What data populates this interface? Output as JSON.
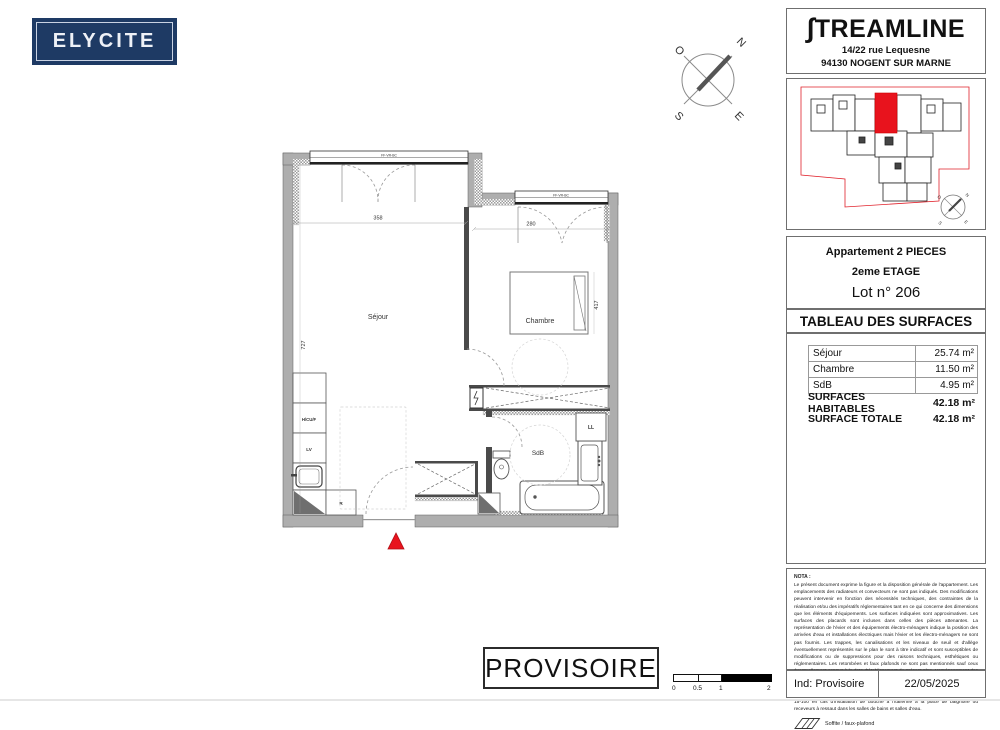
{
  "logo_elycite": {
    "text": "ELYCITE"
  },
  "header_right": {
    "brand_initial": "∫",
    "brand_rest": "TREAMLINE",
    "address1": "14/22 rue Lequesne",
    "address2": "94130 NOGENT SUR MARNE"
  },
  "compass": {
    "n": "N",
    "o": "O",
    "s": "S",
    "e": "E"
  },
  "apartment": {
    "type": "Appartement 2 PIECES",
    "floor": "2eme ETAGE",
    "lot": "Lot n° 206"
  },
  "surfaces": {
    "title": "TABLEAU DES SURFACES",
    "rows": [
      {
        "label": "Séjour",
        "value": "25.74 m²"
      },
      {
        "label": "Chambre",
        "value": "11.50 m²"
      },
      {
        "label": "SdB",
        "value": "4.95 m²"
      }
    ],
    "totals": [
      {
        "label": "SURFACES HABITABLES",
        "value": "42.18 m²"
      },
      {
        "label": "SURFACE TOTALE",
        "value": "42.18 m²"
      }
    ]
  },
  "plan": {
    "rooms": {
      "sejour": "Séjour",
      "chambre": "Chambre",
      "sdb": "SdB"
    },
    "equipment": {
      "hcuf": "H/CU/F",
      "lv": "LV",
      "r": "R",
      "ll": "LL"
    },
    "windows": {
      "sejour_label": "FF-VR-BC",
      "chambre_label": "FF-VR-BC"
    },
    "dimensions": {
      "sejour_width": "358",
      "chambre_width": "280",
      "left_height": "727",
      "bed_length": "417"
    }
  },
  "nota": {
    "title": "NOTA :",
    "body": "Le présent document exprime la figure et la disposition générale de l'appartement. Les emplacements des radiateurs et convecteurs ne sont pas indiqués. Des modifications peuvent intervenir en fonction des nécessités techniques, des contraintes de la réalisation et/ou des impératifs réglementaires tant en ce qui concerne des dimensions que les éléments d'équipements. Les surfaces indiquées sont approximatives. Les surfaces des placards sont incluses dans celles des pièces attenantes. La représentation de l'évier et des équipements électro-ménagers indique la position des arrivées d'eau et installations électriques mais l'évier et les électro-ménagers ne sont pas fournis. Les trappes, les canalisations et les niveaux de seuil et d'allège éventuellement représentés sur le plan le sont à titre indicatif et sont susceptibles de modifications ou de suppressions pour des raisons techniques, esthétiques ou réglementaires. Les retombées et faux plafonds ne sont pas mentionnés sauf ceux éventuellement connus à la date d'établissement du présent plan. L'aménagement des jardins privatifs et la représentation des arbres sont donnés à titre indicatif et susceptibles de changement par le paysagiste.",
    "warning": "Attention à la mise en conformité des équipements électriques selon la norme NFC 15-100 en cas d'installation de douche à l'italienne à la place de baignoire ou receveurs à ressaut dans les salles de bains et salles d'eau.",
    "legend": "Soffite / faux-plafond"
  },
  "footer": {
    "index_label": "Ind: Provisoire",
    "date": "22/05/2025"
  },
  "stamp": {
    "text": "PROVISOIRE"
  },
  "scalebar": {
    "labels": [
      "0",
      "0.5",
      "1",
      "2"
    ]
  },
  "colors": {
    "accent_red": "#e8131d",
    "navy": "#1e3a64"
  }
}
